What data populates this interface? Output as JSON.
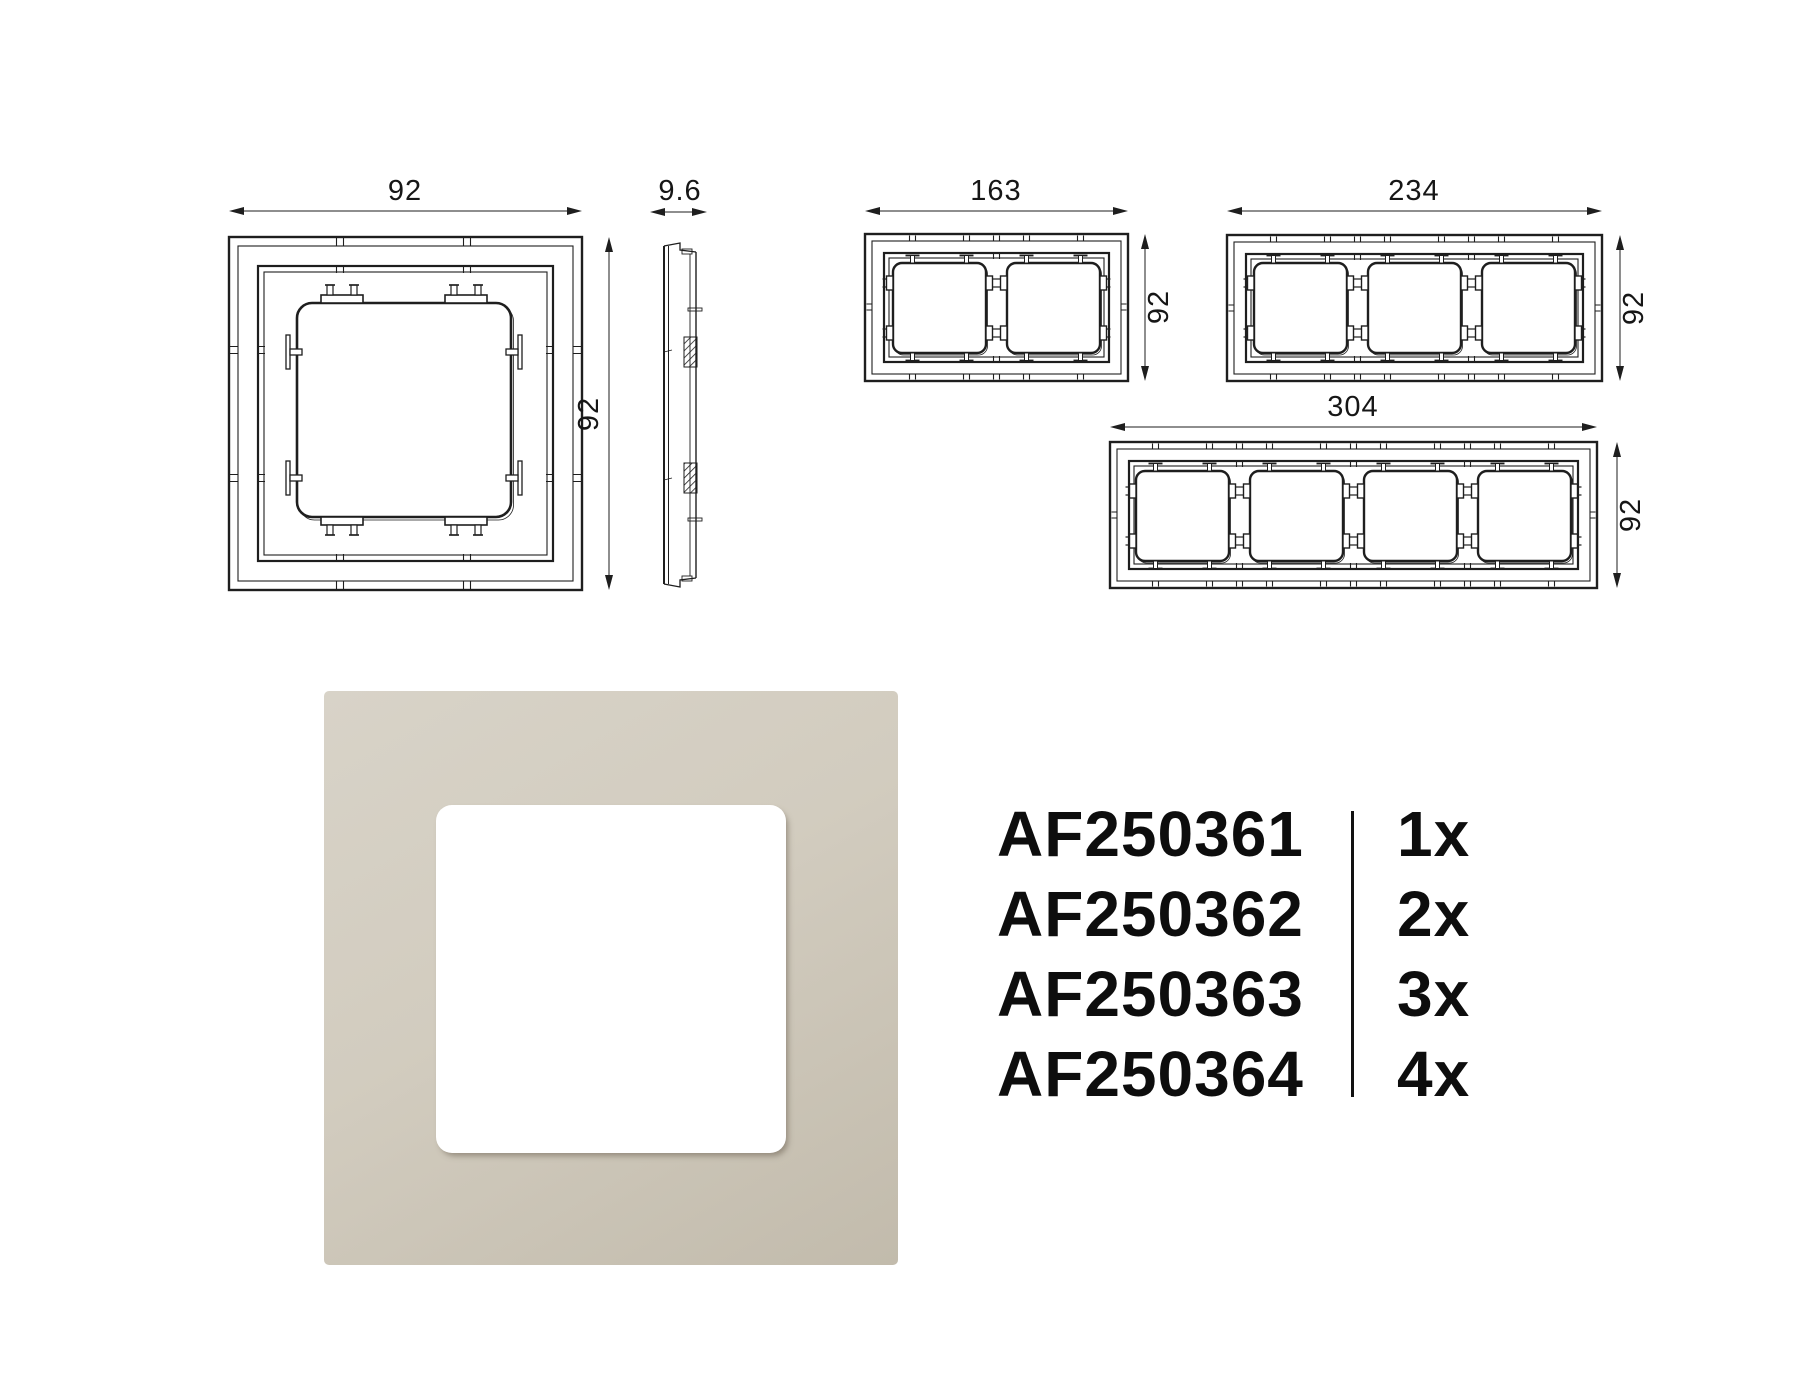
{
  "dimensions": {
    "single_front": {
      "width": "92",
      "height": "92"
    },
    "side_profile": {
      "depth": "9.6"
    },
    "double_frame": {
      "width": "163",
      "height": "92"
    },
    "triple_frame": {
      "width": "234",
      "height": "92"
    },
    "quad_frame": {
      "width": "304",
      "height": "92"
    }
  },
  "product_list": {
    "rows": [
      {
        "sku": "AF250361",
        "qty": "1x"
      },
      {
        "sku": "AF250362",
        "qty": "2x"
      },
      {
        "sku": "AF250363",
        "qty": "3x"
      },
      {
        "sku": "AF250364",
        "qty": "4x"
      }
    ]
  },
  "colors": {
    "line": "#1e1e1e",
    "text": "#0d0d0d",
    "frame_beige_light": "#d8d3c8",
    "frame_beige_dark": "#c2bbac",
    "cutout_white": "#ffffff"
  }
}
